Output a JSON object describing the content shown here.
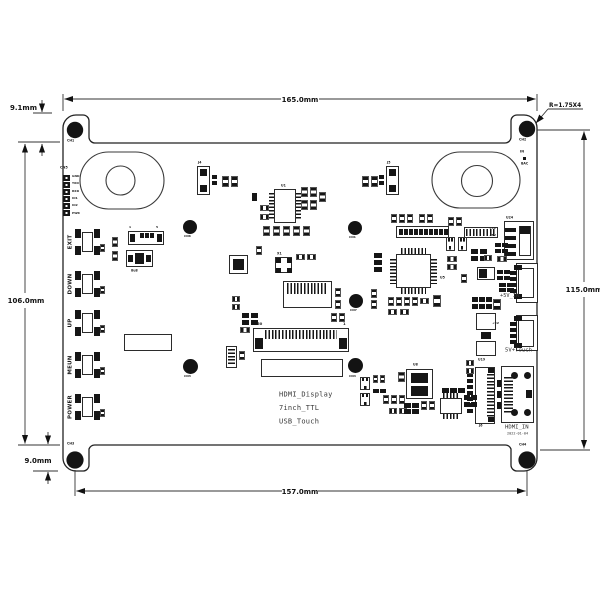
{
  "colors": {
    "ink": "#111111",
    "background": "#ffffff"
  },
  "dimensions": {
    "width_top": "165.0mm",
    "width_bottom_holes": "157.0mm",
    "height_left": "106.0mm",
    "height_right": "115.0mm",
    "top_edge_offset": "9.1mm",
    "bottom_edge_offset": "9.0mm",
    "corner_note": "R=1.75X4"
  },
  "silkscreen_title": {
    "line1": "HDMI_Display",
    "line2": "7inch_TTL",
    "line3": "USB_Touch"
  },
  "buttons": [
    {
      "label": "EXIT"
    },
    {
      "label": "DOWN"
    },
    {
      "label": "UP"
    },
    {
      "label": "MEUN"
    },
    {
      "label": "POWER"
    }
  ],
  "connectors": {
    "power_usb": "+5V_IN",
    "touch_usb": "5V+Touch",
    "hdmi": "HDMI_IN",
    "date_code": "2022-01-04"
  },
  "debug_header": {
    "name": "CN5",
    "pins": [
      "GND",
      "TXD",
      "RXD",
      "IO1",
      "IO2",
      "PWR"
    ]
  },
  "hole_labels": [
    "CH1",
    "CH2",
    "CH3",
    "CH4"
  ],
  "via_labels": [
    "CN6",
    "CN1",
    "CN7",
    "CN3",
    "CN4"
  ],
  "ref_labels": [
    "U1",
    "J4",
    "J5",
    "8u8",
    "U8",
    "U24",
    "U19",
    "U5",
    "X1",
    "J6",
    "IN",
    "BAC",
    "+5V",
    "+5V",
    "+5V",
    "50",
    "1",
    "1",
    "5"
  ]
}
